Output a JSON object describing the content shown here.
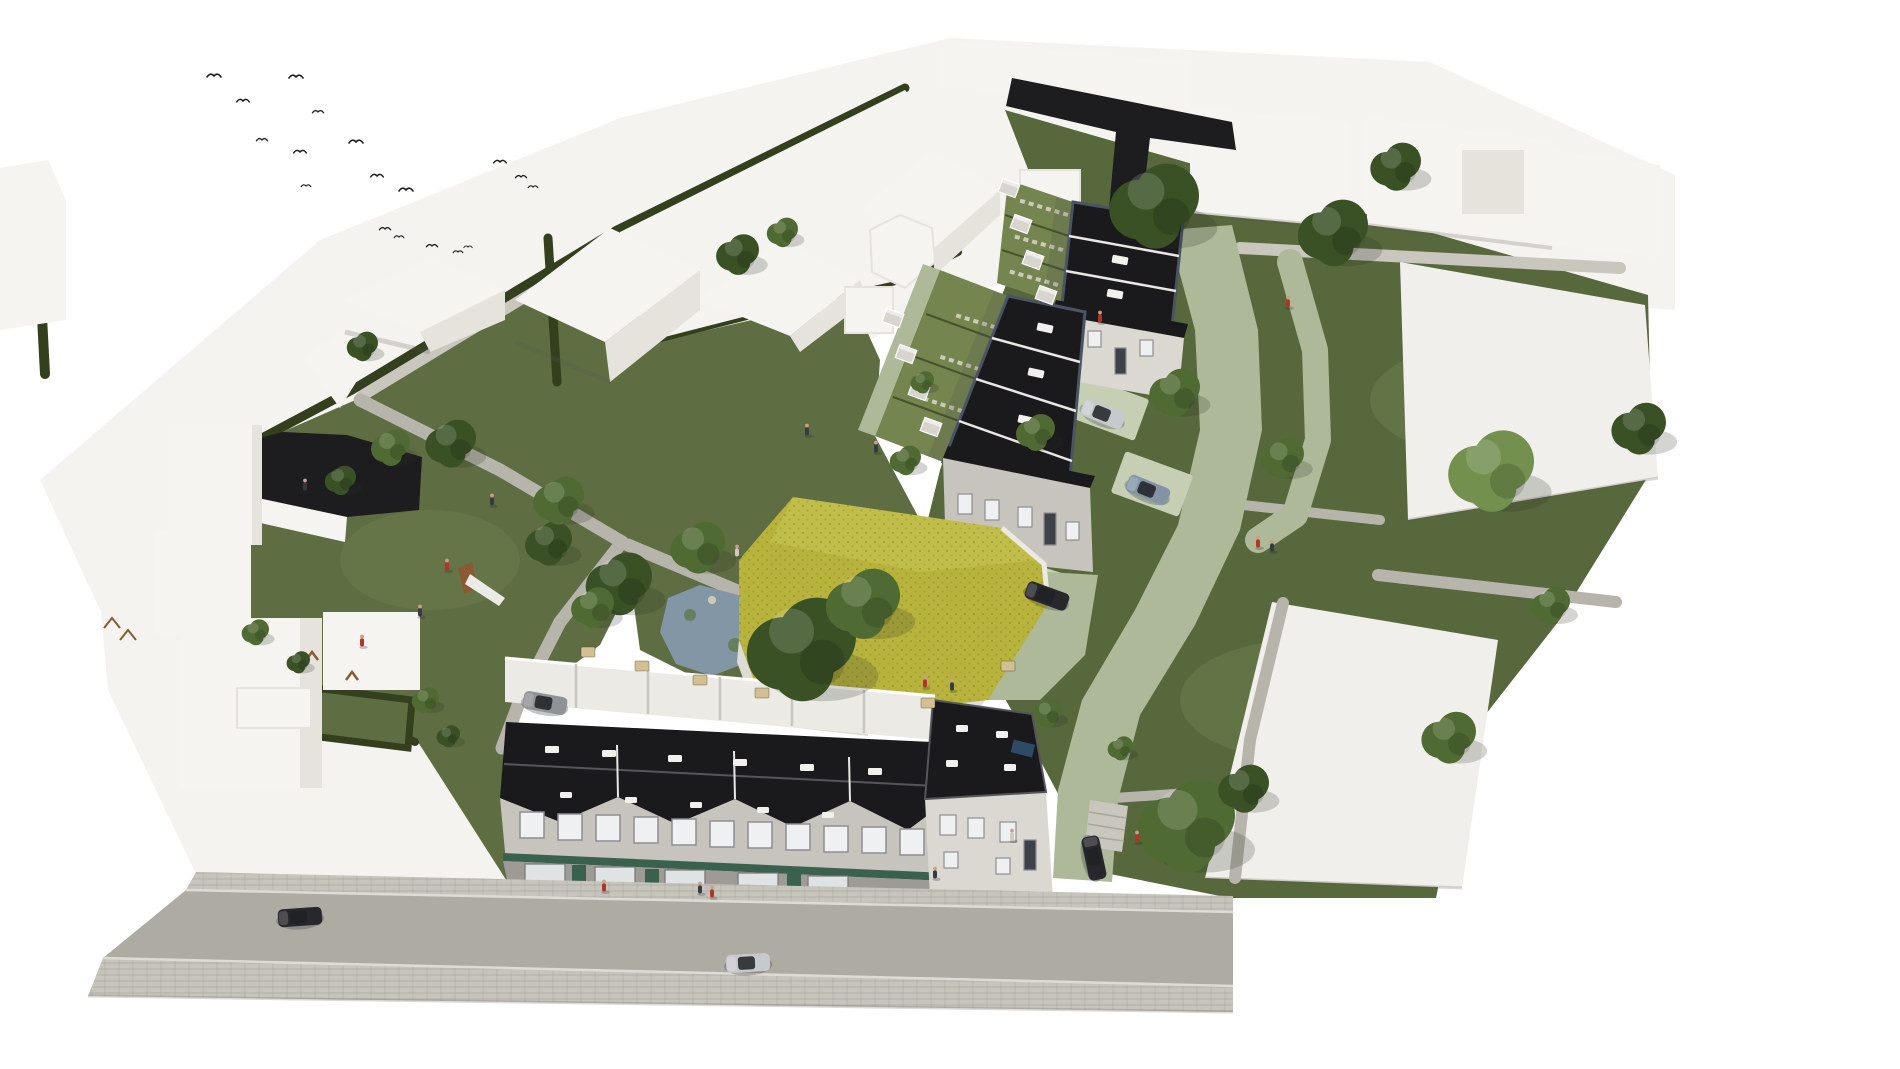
{
  "meta": {
    "description": "Photorealistic aerial bird's-eye architectural rendering of a residential infill development: two rows of black flat-roofed terraced houses with back gardens, a large hall with a yellow-green honeycomb roof, a street-front mixed-use building with green shopfronts, a pond, a playground with slide, green shared lanes, two empty white plots, surrounding abstract white context buildings, scattered trees, cars, tiny people and a flock of birds on a white background",
    "view": "aerial-perspective",
    "text_content": "none - image contains no readable text"
  },
  "colors": {
    "background": "#ffffff",
    "context_ground": "#f5f3f0",
    "context_face_light": "#f6f4f1",
    "context_face_mid": "#e6e3dd",
    "context_shadow": "rgba(90,88,82,0.22)",
    "dark_band": "#1d1d1f",
    "dark_roof": "#1a1a1d",
    "roof_trim": "#4a5464",
    "roof_divider": "#e9e7e3",
    "facade_grey": "#c7c4be",
    "facade_light": "#dbd8d2",
    "facade_dark": "#9e9b96",
    "window_glass": "#eef0f2",
    "window_frame": "#8f8d92",
    "storefront_green": "#3a614d",
    "green_roof": "#b8b33c",
    "green_roof_light": "#c9c553",
    "hall_wall": "#dedbd5",
    "terrace_floor": "#eceae5",
    "grass": "#5e6e42",
    "grass_east": "#57683c",
    "grass_light": "#74854f",
    "grass_pale": "#8fa06b",
    "lane_paver": "#adb998",
    "paver_light": "#c6cfb4",
    "hedge": "#333f1d",
    "path": "#b7b4ac",
    "path_light": "#c9c6be",
    "road": "#aeaba3",
    "sidewalk": "#c7c4bc",
    "curb": "#dedbd5",
    "pond": "#8396a6",
    "pond_plant": "#5f7a4e",
    "tree_dark": "#3a5126",
    "tree_mid": "#506a33",
    "tree_light": "#73904f",
    "car_dark": "#28282c",
    "car_silver": "#c7cacd",
    "car_blue": "#8494a6",
    "car_grey": "#8f9296",
    "person_red": "#b03528",
    "person_dark": "#363b42",
    "person_light": "#cfc9c0",
    "bird": "#1d1d1f",
    "shed": "#d8d5cf",
    "table": "#d3bf94",
    "slide_wood": "#8a5a33",
    "stone": "#cfc9b8",
    "white_plot": "#f1efeb",
    "pool_panel": "#2e4a66",
    "shadow": "rgba(70,70,75,0.18)"
  },
  "counts": {
    "birds": 18,
    "trees": 33,
    "people": 20,
    "cars": 7,
    "garden_sheds": 8,
    "terrace_tables": 6,
    "row1_roof_panels": 3,
    "row2_roof_panels": 4,
    "empty_white_plots": 2
  },
  "entities": {
    "birds": [
      [
        214,
        76,
        1
      ],
      [
        243,
        101,
        0.9
      ],
      [
        296,
        77,
        1
      ],
      [
        262,
        140,
        0.8
      ],
      [
        300,
        152,
        0.9
      ],
      [
        318,
        112,
        0.8
      ],
      [
        356,
        142,
        1
      ],
      [
        377,
        176,
        0.9
      ],
      [
        306,
        186,
        0.7
      ],
      [
        406,
        190,
        1
      ],
      [
        385,
        229,
        0.8
      ],
      [
        399,
        237,
        0.7
      ],
      [
        432,
        246,
        0.8
      ],
      [
        458,
        252,
        0.7
      ],
      [
        468,
        247,
        0.6
      ],
      [
        500,
        162,
        0.9
      ],
      [
        521,
        177,
        0.8
      ],
      [
        533,
        187,
        0.7
      ]
    ],
    "trees": [
      [
        1153,
        205,
        46,
        "dark"
      ],
      [
        1332,
        232,
        36,
        "dark"
      ],
      [
        1395,
        166,
        26,
        "dark"
      ],
      [
        1174,
        392,
        26,
        "mid"
      ],
      [
        1282,
        458,
        22,
        "mid"
      ],
      [
        1490,
        470,
        44,
        "light"
      ],
      [
        1550,
        605,
        20,
        "mid"
      ],
      [
        1638,
        428,
        28,
        "dark"
      ],
      [
        1185,
        825,
        50,
        "mid"
      ],
      [
        1243,
        788,
        26,
        "dark"
      ],
      [
        1448,
        737,
        28,
        "mid"
      ],
      [
        800,
        648,
        56,
        "dark"
      ],
      [
        862,
        603,
        38,
        "mid"
      ],
      [
        618,
        583,
        34,
        "dark"
      ],
      [
        697,
        547,
        28,
        "mid"
      ],
      [
        548,
        543,
        24,
        "dark"
      ],
      [
        592,
        607,
        22,
        "mid"
      ],
      [
        450,
        443,
        26,
        "dark"
      ],
      [
        558,
        500,
        26,
        "mid"
      ],
      [
        390,
        447,
        20,
        "mid"
      ],
      [
        340,
        480,
        16,
        "dark"
      ],
      [
        1035,
        432,
        20,
        "mid"
      ],
      [
        905,
        460,
        16,
        "mid"
      ],
      [
        362,
        346,
        16,
        "dark"
      ],
      [
        425,
        700,
        14,
        "mid"
      ],
      [
        448,
        736,
        12,
        "dark"
      ],
      [
        1047,
        713,
        15,
        "mid"
      ],
      [
        1120,
        748,
        13,
        "mid"
      ],
      [
        737,
        254,
        22,
        "dark"
      ],
      [
        782,
        232,
        16,
        "mid"
      ],
      [
        255,
        632,
        14,
        "mid"
      ],
      [
        298,
        662,
        12,
        "dark"
      ],
      [
        922,
        382,
        12,
        "mid"
      ]
    ],
    "people": [
      [
        492,
        505,
        "dark"
      ],
      [
        447,
        570,
        "red"
      ],
      [
        420,
        616,
        "dark"
      ],
      [
        362,
        646,
        "red"
      ],
      [
        305,
        490,
        "dark"
      ],
      [
        737,
        556,
        "light"
      ],
      [
        807,
        435,
        "dark"
      ],
      [
        925,
        687,
        "red"
      ],
      [
        952,
        690,
        "dark"
      ],
      [
        1012,
        840,
        "light"
      ],
      [
        700,
        893,
        "dark"
      ],
      [
        712,
        897,
        "red"
      ],
      [
        935,
        878,
        "dark"
      ],
      [
        1288,
        307,
        "red"
      ],
      [
        1258,
        547,
        "red"
      ],
      [
        1272,
        551,
        "dark"
      ],
      [
        1137,
        842,
        "red"
      ],
      [
        876,
        452,
        "dark"
      ],
      [
        1100,
        322,
        "red"
      ],
      [
        604,
        891,
        "red"
      ]
    ],
    "cars": [
      [
        300,
        917,
        -4,
        "dark"
      ],
      [
        748,
        963,
        -3,
        "silver"
      ],
      [
        1103,
        414,
        22,
        "silver"
      ],
      [
        1148,
        490,
        22,
        "blue"
      ],
      [
        1047,
        596,
        20,
        "dark"
      ],
      [
        1094,
        858,
        78,
        "dark"
      ],
      [
        545,
        703,
        10,
        "grey"
      ]
    ],
    "sheds": [
      [
        893,
        318,
        20
      ],
      [
        906,
        354,
        20
      ],
      [
        919,
        391,
        20
      ],
      [
        931,
        427,
        20
      ],
      [
        1009,
        188,
        20
      ],
      [
        1021,
        224,
        20
      ],
      [
        1033,
        260,
        20
      ],
      [
        1046,
        295,
        20
      ]
    ],
    "tables": [
      [
        588,
        652
      ],
      [
        642,
        666
      ],
      [
        700,
        680
      ],
      [
        762,
        693
      ],
      [
        928,
        703
      ],
      [
        1008,
        666
      ]
    ]
  }
}
